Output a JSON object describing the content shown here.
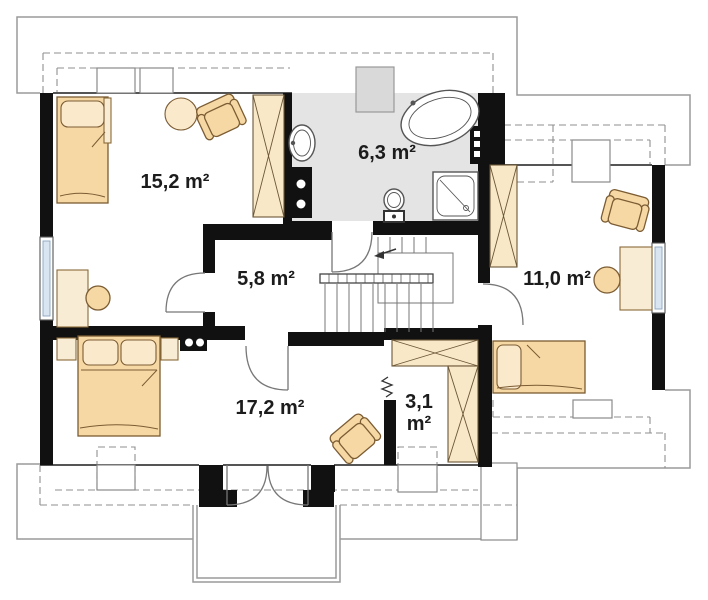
{
  "plan": {
    "type": "attic-floor-plan",
    "rooms": [
      {
        "id": "bedroom-top-left",
        "area": "15,2 m²"
      },
      {
        "id": "bathroom",
        "area": "6,3 m²"
      },
      {
        "id": "hall",
        "area": "5,8 m²"
      },
      {
        "id": "room-right",
        "area": "11,0 m²"
      },
      {
        "id": "bedroom-bottom",
        "area": "17,2 m²"
      },
      {
        "id": "closet",
        "area_line1": "3,1",
        "area_line2": "m²"
      }
    ],
    "fixtures": [
      "bathtub",
      "washbasin",
      "toilet",
      "shower",
      "stairs",
      "chimney",
      "vent-stack"
    ],
    "furniture": [
      "single-bed",
      "double-bed",
      "armchair",
      "round-table",
      "desk",
      "stool",
      "wardrobe",
      "nightstand"
    ],
    "colors": {
      "wall": "#111111",
      "furniture": "#f6d8a4",
      "furniture_light": "#fbe9cc",
      "wardrobe": "#f8e8c8",
      "bathroom_floor": "#e4e4e4",
      "outline": "#9a9a9a",
      "window_glass": "#d9e6f2"
    }
  }
}
